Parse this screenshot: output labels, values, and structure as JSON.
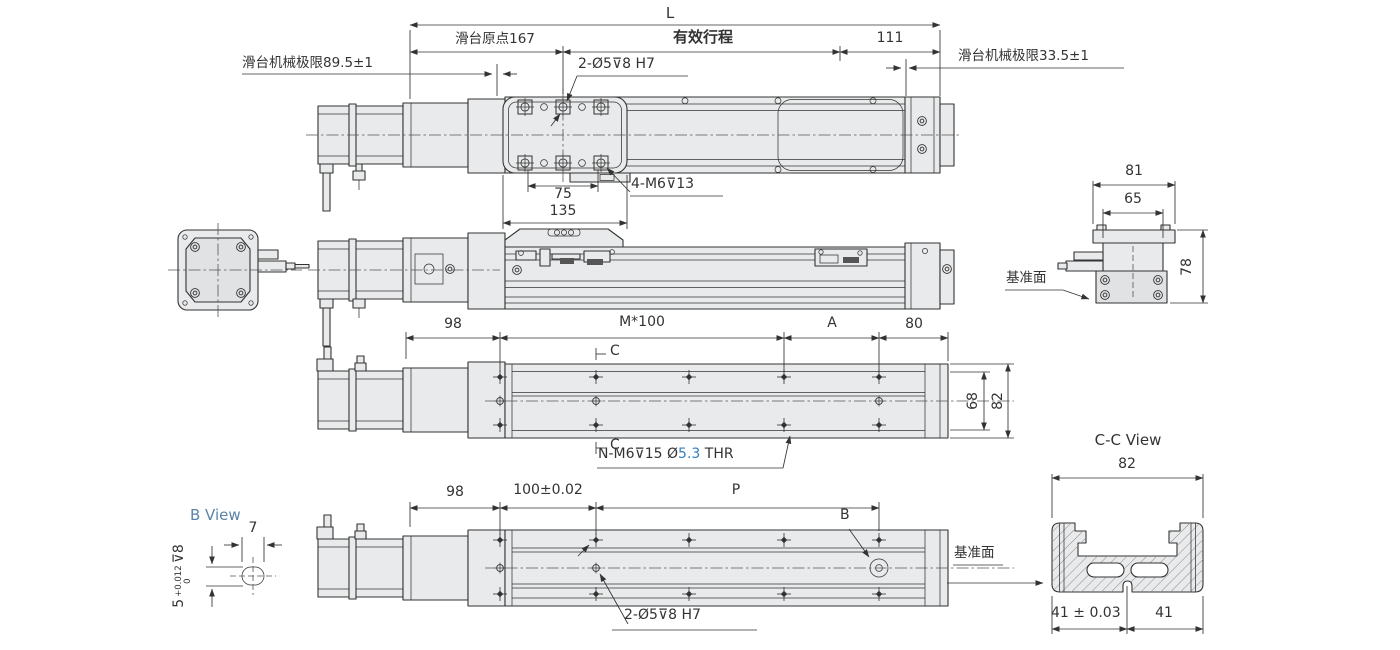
{
  "colors": {
    "line": "#333333",
    "body_fill": "#e9eaeb",
    "accent_blue": "#2f7fc1",
    "view_label_blue": "#5b84a7"
  },
  "top_view": {
    "dim_L": "L",
    "dim_origin": "滑台原点167",
    "dim_effective_stroke": "有效行程",
    "dim_111": "111",
    "label_limit_left": "滑台机械极限89.5±1",
    "label_limit_right": "滑台机械极限33.5±1",
    "label_pin_holes": "2-Ø5⊽8 H7",
    "label_mount_holes": "4-M6⊽13",
    "dim_75": "75",
    "dim_135": "135"
  },
  "end_view_right": {
    "dim_81": "81",
    "dim_65": "65",
    "dim_78": "78",
    "label_datum": "基准面"
  },
  "base_view": {
    "dim_98": "98",
    "dim_pitch": "M*100",
    "dim_A": "A",
    "dim_80": "80",
    "section_mark_top": "C",
    "section_mark_bottom": "C",
    "dim_68": "68",
    "dim_82": "82",
    "label_thread_prefix": "N-M6⊽15 Ø",
    "label_thread_size": "5.3",
    "label_thread_suffix": " THR"
  },
  "bottom_view": {
    "dim_98": "98",
    "dim_100": "100±0.02",
    "dim_P": "P",
    "label_B": "B",
    "label_pin_holes": "2-Ø5⊽8 H7",
    "label_datum": "基准面"
  },
  "cc_view": {
    "title": "C-C View",
    "dim_82": "82",
    "dim_41_tol": "41 ± 0.03",
    "dim_41": "41"
  },
  "b_view": {
    "title": "B View",
    "dim_7": "7",
    "dim_5": "5",
    "tol_plus": "+0.012",
    "tol_zero": "0",
    "depth": "⊽8"
  }
}
